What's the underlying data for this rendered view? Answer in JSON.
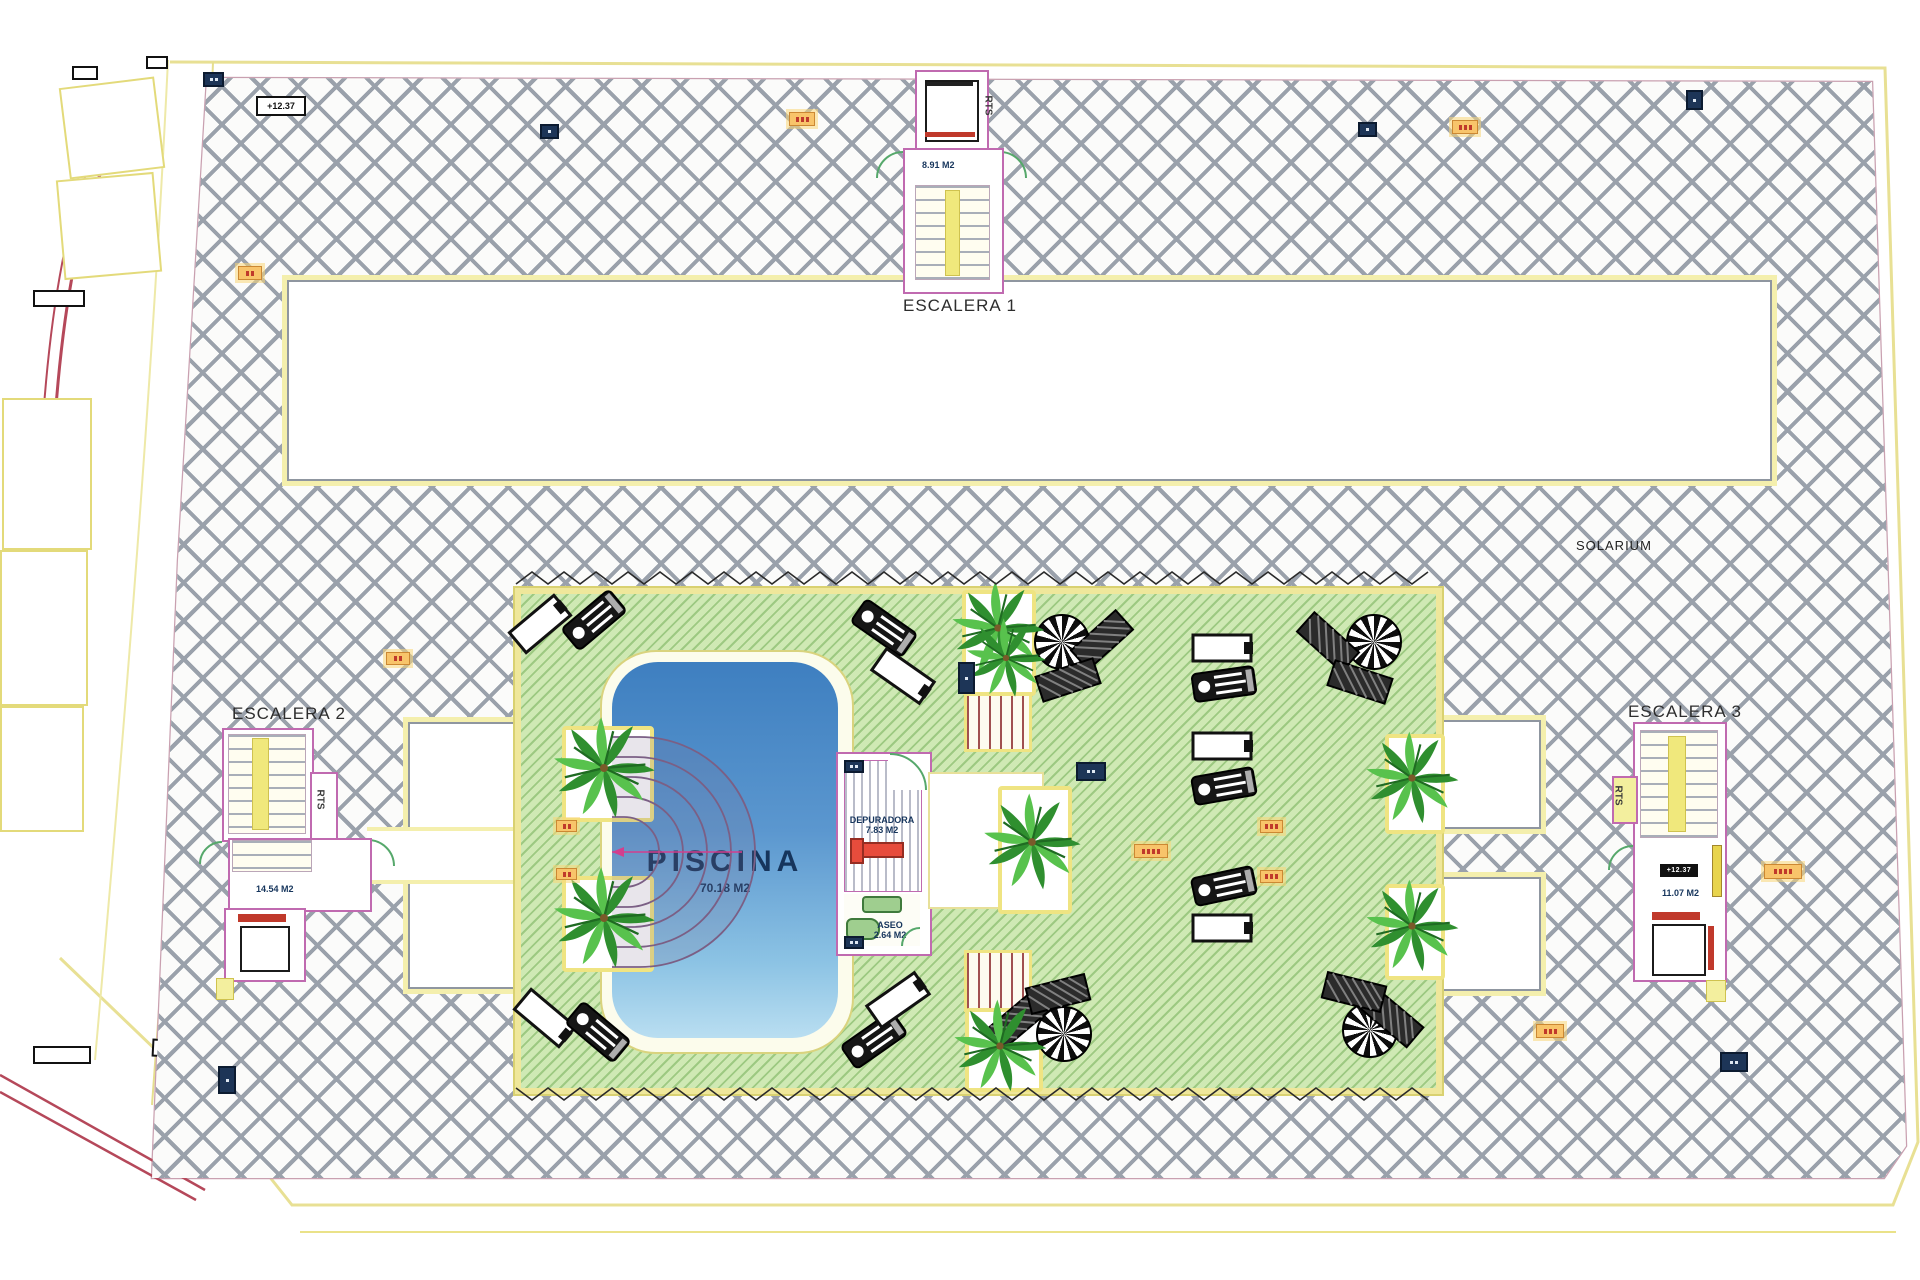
{
  "plan": {
    "solarium_label": "SOLARIUM",
    "level_chip": "+12.37",
    "piscina": {
      "title": "PISCINA",
      "area": "70.18 M2"
    },
    "depuradora": {
      "title": "DEPURADORA",
      "area": "7.83 M2"
    },
    "aseo": {
      "title": "ASEO",
      "area": "2.64 M2"
    },
    "escalera1": {
      "title": "ESCALERA 1",
      "area": "8.91 M2",
      "rts": "RTS"
    },
    "escalera2": {
      "title": "ESCALERA 2",
      "area": "14.54 M2",
      "rts": "RTS"
    },
    "escalera3": {
      "title": "ESCALERA 3",
      "area": "11.07 M2",
      "rts": "RTS",
      "chip": "+12.37"
    },
    "colors": {
      "hatch_line": "#9aa1ab",
      "deck_green": "#cfe9b4",
      "deck_hatch": "#74af58",
      "pool_top": "#3e7fc0",
      "pool_bottom": "#b9def1",
      "wall_pink": "#c06ab0",
      "boundary_yellow": "#efe79b",
      "marker_orange": "#f8c46a",
      "marker_navy": "#1d3557",
      "stair_yellow": "#f0e87c",
      "door_green": "#56a86b",
      "zigzag": "#2a2a2a"
    }
  }
}
